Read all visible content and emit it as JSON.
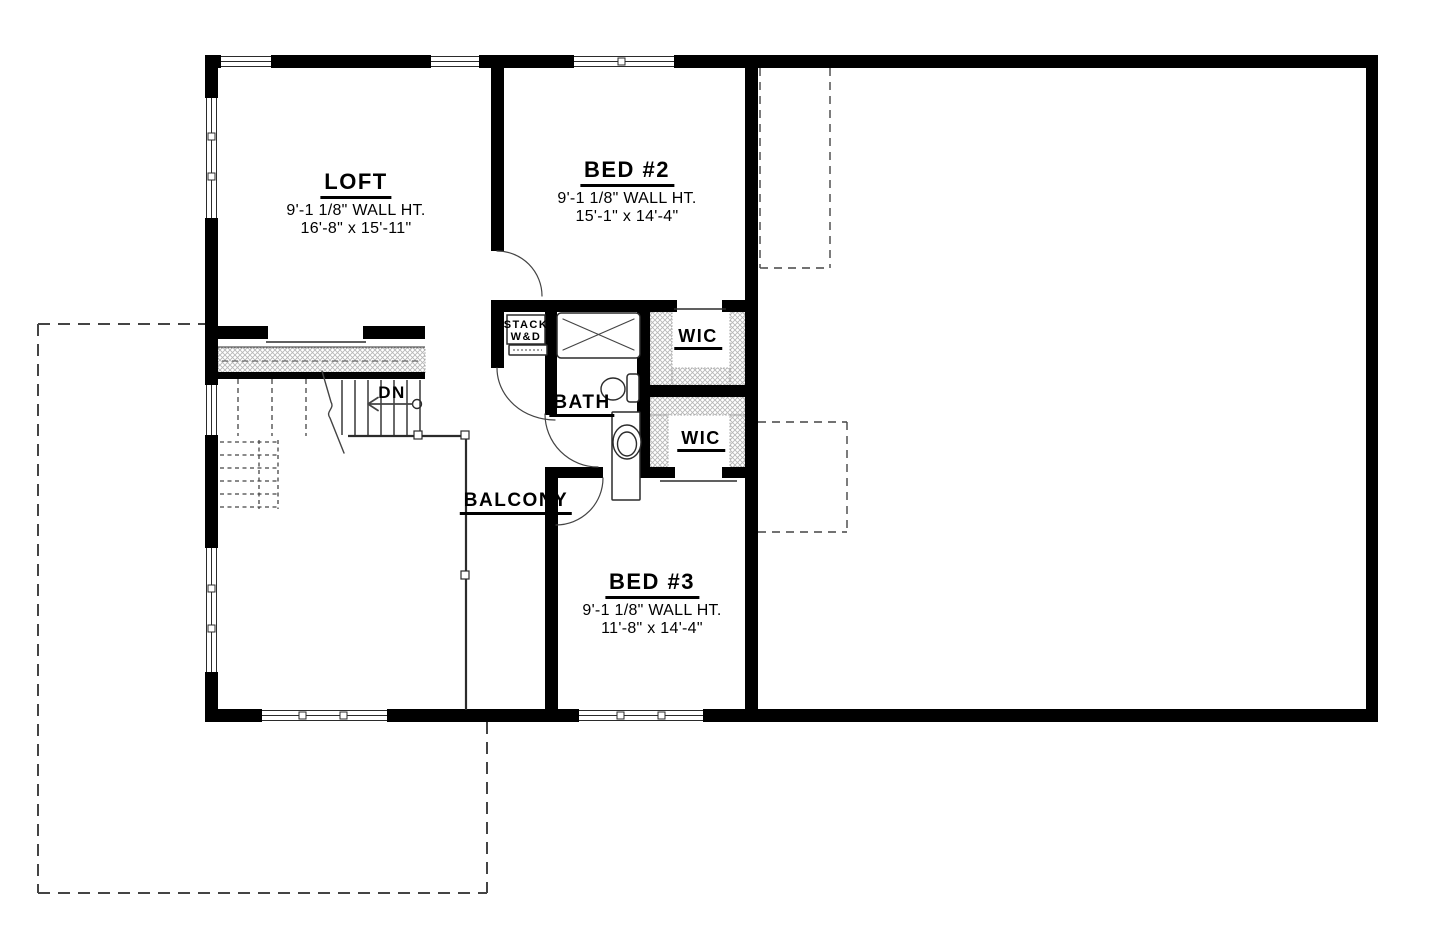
{
  "drawing": {
    "type": "architectural-floor-plan",
    "floor": "upper",
    "colors": {
      "wall": "#000000",
      "line": "#2b2b2b",
      "thin": "#444444",
      "hatch": "#b7b7b7",
      "text": "#000000"
    }
  },
  "plan": {
    "labels": [
      {
        "id": "loft",
        "cx": 356,
        "y": 170,
        "lines": [
          {
            "t": "LOFT",
            "s": 22,
            "u": true
          },
          {
            "t": "9'-1 1/8\" WALL HT.",
            "s": 16
          },
          {
            "t": "16'-8\" x 15'-11\"",
            "s": 16
          }
        ]
      },
      {
        "id": "bed-2",
        "cx": 627,
        "y": 158,
        "lines": [
          {
            "t": "BED #2",
            "s": 22,
            "u": true
          },
          {
            "t": "9'-1 1/8\" WALL HT.",
            "s": 16
          },
          {
            "t": "15'-1\" x 14'-4\"",
            "s": 16
          }
        ]
      },
      {
        "id": "bed-3",
        "cx": 652,
        "y": 570,
        "lines": [
          {
            "t": "BED #3",
            "s": 22,
            "u": true
          },
          {
            "t": "9'-1 1/8\" WALL HT.",
            "s": 16
          },
          {
            "t": "11'-8\" x 14'-4\"",
            "s": 16
          }
        ]
      },
      {
        "id": "bath",
        "cx": 582,
        "y": 392,
        "lines": [
          {
            "t": "BATH",
            "s": 19,
            "u": true
          }
        ]
      },
      {
        "id": "wic-upper",
        "cx": 698,
        "y": 326,
        "lines": [
          {
            "t": "WIC",
            "s": 18,
            "u": true
          }
        ]
      },
      {
        "id": "wic-lower",
        "cx": 701,
        "y": 428,
        "lines": [
          {
            "t": "WIC",
            "s": 18,
            "u": true
          }
        ]
      },
      {
        "id": "balcony",
        "cx": 516,
        "y": 490,
        "lines": [
          {
            "t": "BALCONY",
            "s": 19,
            "u": true
          }
        ]
      },
      {
        "id": "stairs-dn",
        "cx": 392,
        "y": 383,
        "lines": [
          {
            "t": "DN",
            "s": 17
          }
        ]
      },
      {
        "id": "stack-wd",
        "cx": 526,
        "y": 319,
        "lines": [
          {
            "t": "STACK",
            "s": 11
          },
          {
            "t": "W&D",
            "s": 11
          }
        ]
      }
    ],
    "walls": [
      [
        205,
        55,
        1173,
        13
      ],
      [
        205,
        55,
        13,
        667
      ],
      [
        205,
        709,
        1173,
        13
      ],
      [
        1366,
        55,
        12,
        667
      ],
      [
        745,
        68,
        13,
        641
      ],
      [
        491,
        68,
        13,
        183
      ],
      [
        213,
        326,
        55,
        13
      ],
      [
        363,
        326,
        62,
        13
      ],
      [
        218,
        372,
        207,
        7
      ],
      [
        491,
        300,
        186,
        12
      ],
      [
        722,
        300,
        36,
        12
      ],
      [
        491,
        312,
        13,
        56
      ],
      [
        545,
        312,
        12,
        56
      ],
      [
        545,
        368,
        12,
        47
      ],
      [
        637,
        302,
        13,
        176
      ],
      [
        643,
        385,
        115,
        12
      ],
      [
        545,
        467,
        58,
        11
      ],
      [
        637,
        467,
        38,
        11
      ],
      [
        722,
        467,
        36,
        11
      ],
      [
        545,
        478,
        13,
        231
      ]
    ],
    "windows": [
      {
        "x": 221,
        "y": 55,
        "w": 50,
        "h": 13,
        "o": "h"
      },
      {
        "x": 431,
        "y": 55,
        "w": 48,
        "h": 13,
        "o": "h"
      },
      {
        "x": 574,
        "y": 55,
        "w": 100,
        "h": 13,
        "o": "h"
      },
      {
        "x": 205,
        "y": 98,
        "w": 13,
        "h": 120,
        "o": "v"
      },
      {
        "x": 205,
        "y": 385,
        "w": 13,
        "h": 50,
        "o": "v"
      },
      {
        "x": 205,
        "y": 548,
        "w": 13,
        "h": 124,
        "o": "v"
      },
      {
        "x": 262,
        "y": 709,
        "w": 125,
        "h": 13,
        "o": "h"
      },
      {
        "x": 579,
        "y": 709,
        "w": 124,
        "h": 13,
        "o": "h"
      }
    ],
    "mullions": [
      [
        618,
        58
      ],
      [
        208,
        133
      ],
      [
        208,
        173
      ],
      [
        208,
        585
      ],
      [
        208,
        625
      ],
      [
        299,
        712
      ],
      [
        340,
        712
      ],
      [
        617,
        712
      ],
      [
        658,
        712
      ]
    ],
    "hatches": [
      [
        218,
        348,
        207,
        26
      ],
      [
        650,
        312,
        22,
        73
      ],
      [
        730,
        312,
        15,
        73
      ],
      [
        672,
        368,
        58,
        17
      ],
      [
        650,
        397,
        95,
        18
      ],
      [
        650,
        415,
        18,
        52
      ],
      [
        730,
        415,
        15,
        52
      ]
    ],
    "fixture_rects": [
      {
        "x": 557,
        "y": 313,
        "w": 83,
        "h": 45,
        "rx": 4,
        "name": "shower"
      },
      {
        "x": 612,
        "y": 412,
        "w": 28,
        "h": 88,
        "rx": 1,
        "name": "vanity-counter"
      },
      {
        "x": 507,
        "y": 315,
        "w": 38,
        "h": 29,
        "rx": 0,
        "name": "washer-dryer-label-box"
      },
      {
        "x": 509,
        "y": 345,
        "w": 38,
        "h": 10,
        "rx": 1,
        "name": "washer-dryer-front"
      },
      {
        "x": 627,
        "y": 374,
        "w": 12,
        "h": 28,
        "rx": 3,
        "name": "toilet-tank"
      }
    ],
    "ellipses": [
      {
        "cx": 613,
        "cy": 389,
        "rx": 12,
        "ry": 11,
        "name": "toilet-bowl"
      },
      {
        "cx": 627,
        "cy": 442,
        "rx": 14,
        "ry": 17,
        "name": "sink-basin-outer"
      },
      {
        "cx": 627,
        "cy": 444,
        "rx": 9.5,
        "ry": 12,
        "name": "sink-basin-inner"
      },
      {
        "cx": 417,
        "cy": 404,
        "rx": 4.5,
        "ry": 4.5,
        "name": "stair-arrow-origin"
      }
    ],
    "solid_lines": [
      {
        "p": [
          342,
          380,
          342,
          435
        ],
        "w": 1.4,
        "name": "stair-tread"
      },
      {
        "p": [
          355,
          380,
          355,
          435
        ],
        "w": 1.4,
        "name": "stair-tread"
      },
      {
        "p": [
          368,
          380,
          368,
          435
        ],
        "w": 1.4,
        "name": "stair-tread"
      },
      {
        "p": [
          381,
          380,
          381,
          435
        ],
        "w": 1.4,
        "name": "stair-tread"
      },
      {
        "p": [
          394,
          380,
          394,
          435
        ],
        "w": 1.4,
        "name": "stair-tread"
      },
      {
        "p": [
          407,
          380,
          407,
          435
        ],
        "w": 1.4,
        "name": "stair-tread"
      },
      {
        "p": [
          420,
          380,
          420,
          435
        ],
        "w": 1.4,
        "name": "stair-tread"
      },
      {
        "p": [
          348,
          436,
          466,
          436
        ],
        "w": 2.2,
        "name": "balcony-railing"
      },
      {
        "p": [
          466,
          436,
          466,
          710
        ],
        "w": 2.2,
        "name": "balcony-railing"
      },
      {
        "p": [
          218,
          347,
          425,
          347
        ],
        "w": 1,
        "name": "stair-guard-edge"
      },
      {
        "p": [
          266,
          342,
          366,
          342
        ],
        "w": 1.5,
        "name": "loft-opening-sill"
      },
      {
        "p": [
          674,
          309,
          726,
          309
        ],
        "w": 1.5,
        "name": "wic-opening-sill"
      },
      {
        "p": [
          660,
          481,
          737,
          481
        ],
        "w": 1.5,
        "name": "wic-opening-sill"
      }
    ],
    "dashed_lines": [
      {
        "p": [
          238,
          379,
          238,
          436
        ],
        "w": 1.3,
        "d": "5 4",
        "name": "stair-tread-hidden"
      },
      {
        "p": [
          272,
          379,
          272,
          436
        ],
        "w": 1.3,
        "d": "5 4",
        "name": "stair-tread-hidden"
      },
      {
        "p": [
          306,
          379,
          306,
          436
        ],
        "w": 1.3,
        "d": "5 4",
        "name": "stair-tread-hidden"
      },
      {
        "p": [
          220,
          442,
          278,
          442
        ],
        "w": 1.3,
        "d": "4 3.5",
        "name": "stair-below-hidden"
      },
      {
        "p": [
          220,
          455,
          278,
          455
        ],
        "w": 1.3,
        "d": "4 3.5",
        "name": "stair-below-hidden"
      },
      {
        "p": [
          220,
          468,
          278,
          468
        ],
        "w": 1.3,
        "d": "4 3.5",
        "name": "stair-below-hidden"
      },
      {
        "p": [
          220,
          481,
          278,
          481
        ],
        "w": 1.3,
        "d": "4 3.5",
        "name": "stair-below-hidden"
      },
      {
        "p": [
          220,
          494,
          278,
          494
        ],
        "w": 1.3,
        "d": "4 3.5",
        "name": "stair-below-hidden"
      },
      {
        "p": [
          220,
          507,
          278,
          507
        ],
        "w": 1.3,
        "d": "4 3.5",
        "name": "stair-below-hidden"
      },
      {
        "p": [
          259,
          440,
          259,
          509
        ],
        "w": 1.3,
        "d": "4 3.5",
        "name": "stair-below-hidden"
      },
      {
        "p": [
          278,
          440,
          278,
          509
        ],
        "w": 1.3,
        "d": "4 3.5",
        "name": "stair-below-hidden"
      },
      {
        "p": [
          222,
          361,
          420,
          361
        ],
        "w": 1,
        "d": "6 4",
        "name": "stair-guard-centerline"
      },
      {
        "p": [
          513,
          350,
          542,
          350
        ],
        "w": 0.9,
        "d": "2 2",
        "name": "appliance-detail"
      },
      {
        "p": [
          760,
          68,
          760,
          268
        ],
        "w": 1.4,
        "d": "8 6",
        "name": "overhead-outline"
      },
      {
        "p": [
          830,
          68,
          830,
          268
        ],
        "w": 1.4,
        "d": "8 6",
        "name": "overhead-outline"
      },
      {
        "p": [
          760,
          268,
          830,
          268
        ],
        "w": 1.4,
        "d": "8 6",
        "name": "overhead-outline"
      },
      {
        "p": [
          758,
          422,
          847,
          422
        ],
        "w": 1.4,
        "d": "8 6",
        "name": "overhead-outline"
      },
      {
        "p": [
          847,
          422,
          847,
          532
        ],
        "w": 1.4,
        "d": "8 6",
        "name": "overhead-outline"
      },
      {
        "p": [
          758,
          532,
          847,
          532
        ],
        "w": 1.4,
        "d": "8 6",
        "name": "overhead-outline"
      },
      {
        "p": [
          38,
          324,
          38,
          893
        ],
        "w": 2,
        "d": "12 8",
        "name": "roof-below-outline"
      },
      {
        "p": [
          38,
          324,
          205,
          324
        ],
        "w": 2,
        "d": "12 8",
        "name": "roof-below-outline"
      },
      {
        "p": [
          38,
          893,
          487,
          893
        ],
        "w": 2,
        "d": "12 8",
        "name": "roof-below-outline"
      },
      {
        "p": [
          487,
          722,
          487,
          893
        ],
        "w": 2,
        "d": "12 8",
        "name": "roof-below-outline"
      }
    ],
    "paths": [
      {
        "d": "M497 251 A45 45 0 0 1 542 296",
        "w": 1.2,
        "name": "door-swing-bed2"
      },
      {
        "d": "M497 368 A58 52 0 0 0 555 420",
        "w": 1.2,
        "name": "door-swing-hall"
      },
      {
        "d": "M545 414 A53 53 0 0 0 598 467",
        "w": 1.2,
        "name": "door-swing-bath"
      },
      {
        "d": "M603 478 A47 47 0 0 1 556 525",
        "w": 1.2,
        "name": "door-swing-balcony"
      },
      {
        "d": "M563 319 L634 350 M634 319 L563 350",
        "w": 1.2,
        "name": "shower-x"
      },
      {
        "d": "M322 371 L331 402 C335 409 325 411 330 418 L344 453",
        "w": 1.4,
        "name": "stair-break-line"
      },
      {
        "d": "M412 404 L368 404 M368 404 L378 397.5 M368 404 L378 410.5",
        "w": 1.7,
        "name": "stair-down-arrow"
      }
    ],
    "posts": [
      [
        414,
        431
      ],
      [
        461,
        431
      ],
      [
        461,
        571
      ]
    ]
  }
}
